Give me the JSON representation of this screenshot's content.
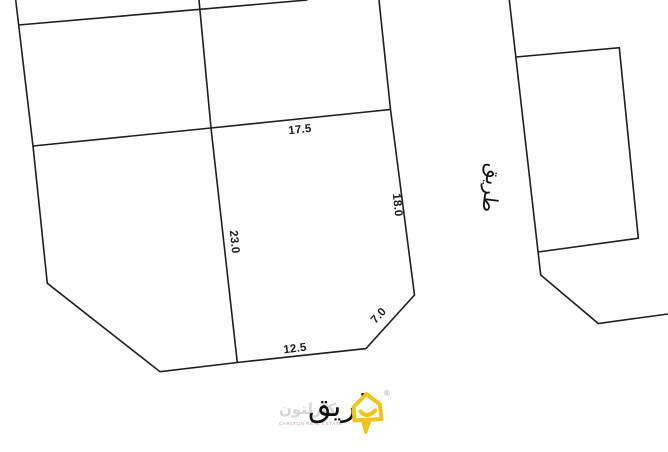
{
  "plan": {
    "dimensions": {
      "north": "17.5",
      "east": "18.0",
      "inner_west": "23.0",
      "south": "12.5",
      "chamfer": "7.0"
    },
    "road_east_label": "طريق",
    "road_south_label": "طريق"
  },
  "watermark": {
    "brand_arabic": "كارلتون",
    "brand_caption": "CARLTON REAL ESTATE",
    "registered_symbol": "®"
  },
  "colors": {
    "line": "#1e1e1e",
    "label_text": "#1a1a1a",
    "logo_yellow": "#F2C414",
    "watermark_gray": "#d7d7d7"
  }
}
